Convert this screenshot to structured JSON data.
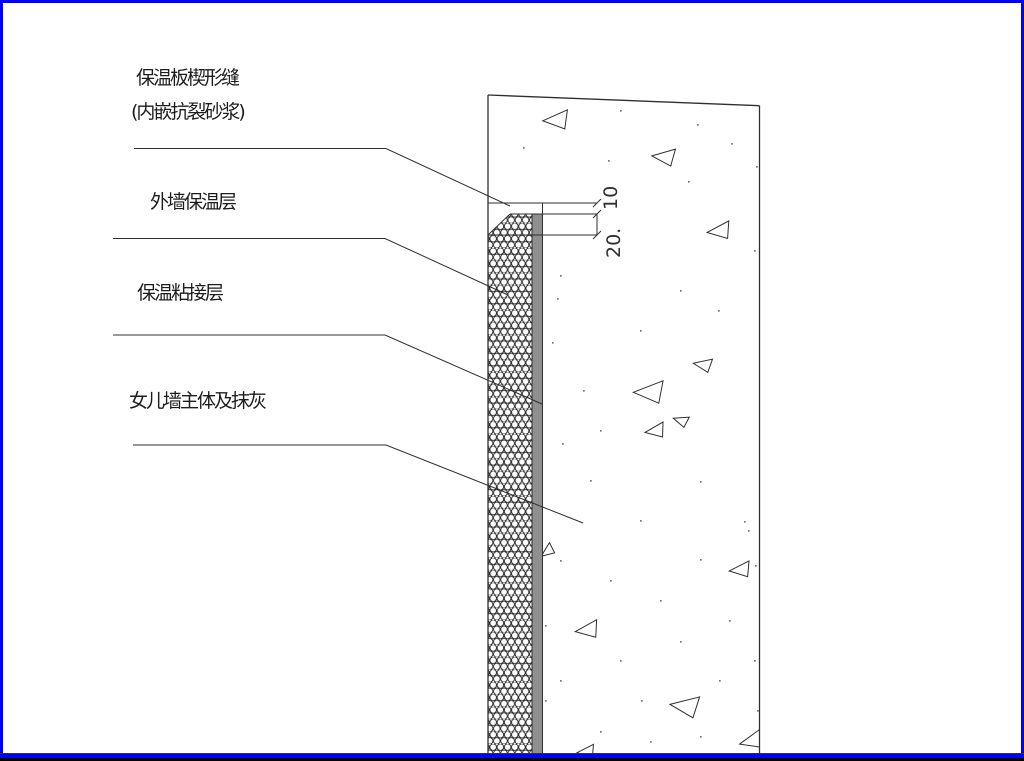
{
  "drawing": {
    "type": "construction-detail",
    "labels": {
      "wedge_seam_line1": "保温板楔形缝",
      "wedge_seam_line2": "(内嵌抗裂砂浆)",
      "exterior_insulation": "外墙保温层",
      "adhesive_layer": "保温粘接层",
      "parapet_body": "女儿墙主体及抹灰"
    },
    "dimensions": {
      "seam_mouth": "10",
      "seam_depth": "20."
    },
    "colors": {
      "frame_blue": "#0000ff",
      "frame_black": "#000000",
      "adhesive_gray": "#8f8f8f",
      "line_color": "#2f2f2f",
      "background": "#ffffff"
    },
    "texture": {
      "triangles": [
        [
          556,
          119,
          22,
          0
        ],
        [
          664,
          156,
          20,
          8
        ],
        [
          719,
          230,
          20,
          -4
        ],
        [
          703,
          364,
          16,
          12
        ],
        [
          649,
          391,
          26,
          3
        ],
        [
          655,
          430,
          17,
          -6
        ],
        [
          681,
          420,
          13,
          20
        ],
        [
          547,
          551,
          13,
          -35
        ],
        [
          587,
          629,
          20,
          -5
        ],
        [
          685,
          705,
          25,
          10
        ],
        [
          740,
          569,
          18,
          -3
        ],
        [
          751,
          740,
          20,
          -12
        ],
        [
          586,
          751,
          15,
          -3
        ]
      ],
      "dots": [
        [
          620,
          110
        ],
        [
          697,
          124
        ],
        [
          523,
          147
        ],
        [
          608,
          160
        ],
        [
          756,
          166
        ],
        [
          688,
          181
        ],
        [
          731,
          143
        ],
        [
          560,
          275
        ],
        [
          557,
          298
        ],
        [
          680,
          290
        ],
        [
          718,
          310
        ],
        [
          754,
          250
        ],
        [
          640,
          330
        ],
        [
          552,
          342
        ],
        [
          583,
          390
        ],
        [
          600,
          430
        ],
        [
          562,
          443
        ],
        [
          590,
          480
        ],
        [
          640,
          520
        ],
        [
          700,
          481
        ],
        [
          744,
          521
        ],
        [
          560,
          560
        ],
        [
          610,
          580
        ],
        [
          660,
          600
        ],
        [
          729,
          620
        ],
        [
          700,
          559
        ],
        [
          754,
          660
        ],
        [
          620,
          660
        ],
        [
          560,
          680
        ],
        [
          680,
          641
        ],
        [
          719,
          680
        ],
        [
          641,
          700
        ],
        [
          545,
          625
        ],
        [
          757,
          710
        ],
        [
          600,
          731
        ],
        [
          650,
          741
        ],
        [
          700,
          736
        ],
        [
          545,
          700
        ],
        [
          748,
          530
        ],
        [
          755,
          565
        ]
      ]
    }
  }
}
